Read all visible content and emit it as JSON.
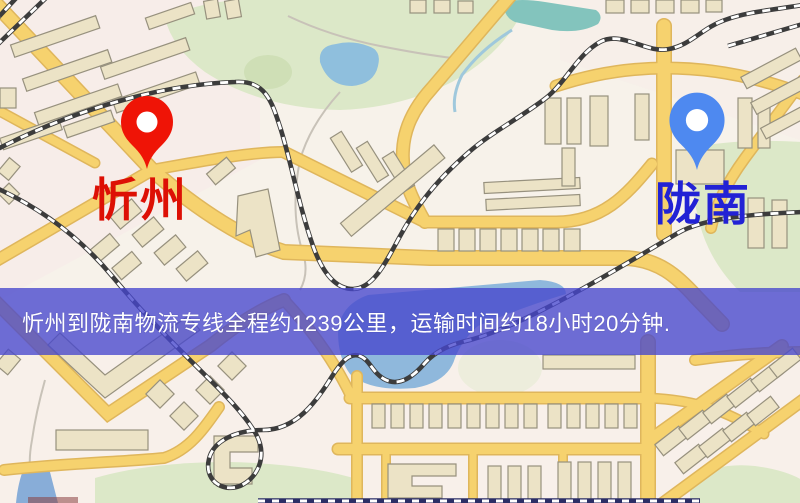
{
  "map": {
    "origin_marker": {
      "label": "忻州",
      "pin_color": "#ef1406",
      "label_color": "#dd1005"
    },
    "destination_marker": {
      "label": "陇南",
      "pin_color": "#4e89f0",
      "label_color": "#2222d5"
    },
    "info_banner": {
      "text": "忻州到陇南物流专线全程约1239公里，运输时间约18小时20分钟.",
      "background_color": "#4646cd",
      "text_color": "#ffffff",
      "distance": "约1239公里",
      "duration": "约18小时20分钟"
    },
    "palette": {
      "map_background": "#f7f2ea",
      "road": "#f6d26e",
      "road_casing": "#dfb65c",
      "park": "#dce8c8",
      "water": "#8fbfdd",
      "building": "#ece3c6",
      "railway": "#3c3c3c"
    }
  }
}
